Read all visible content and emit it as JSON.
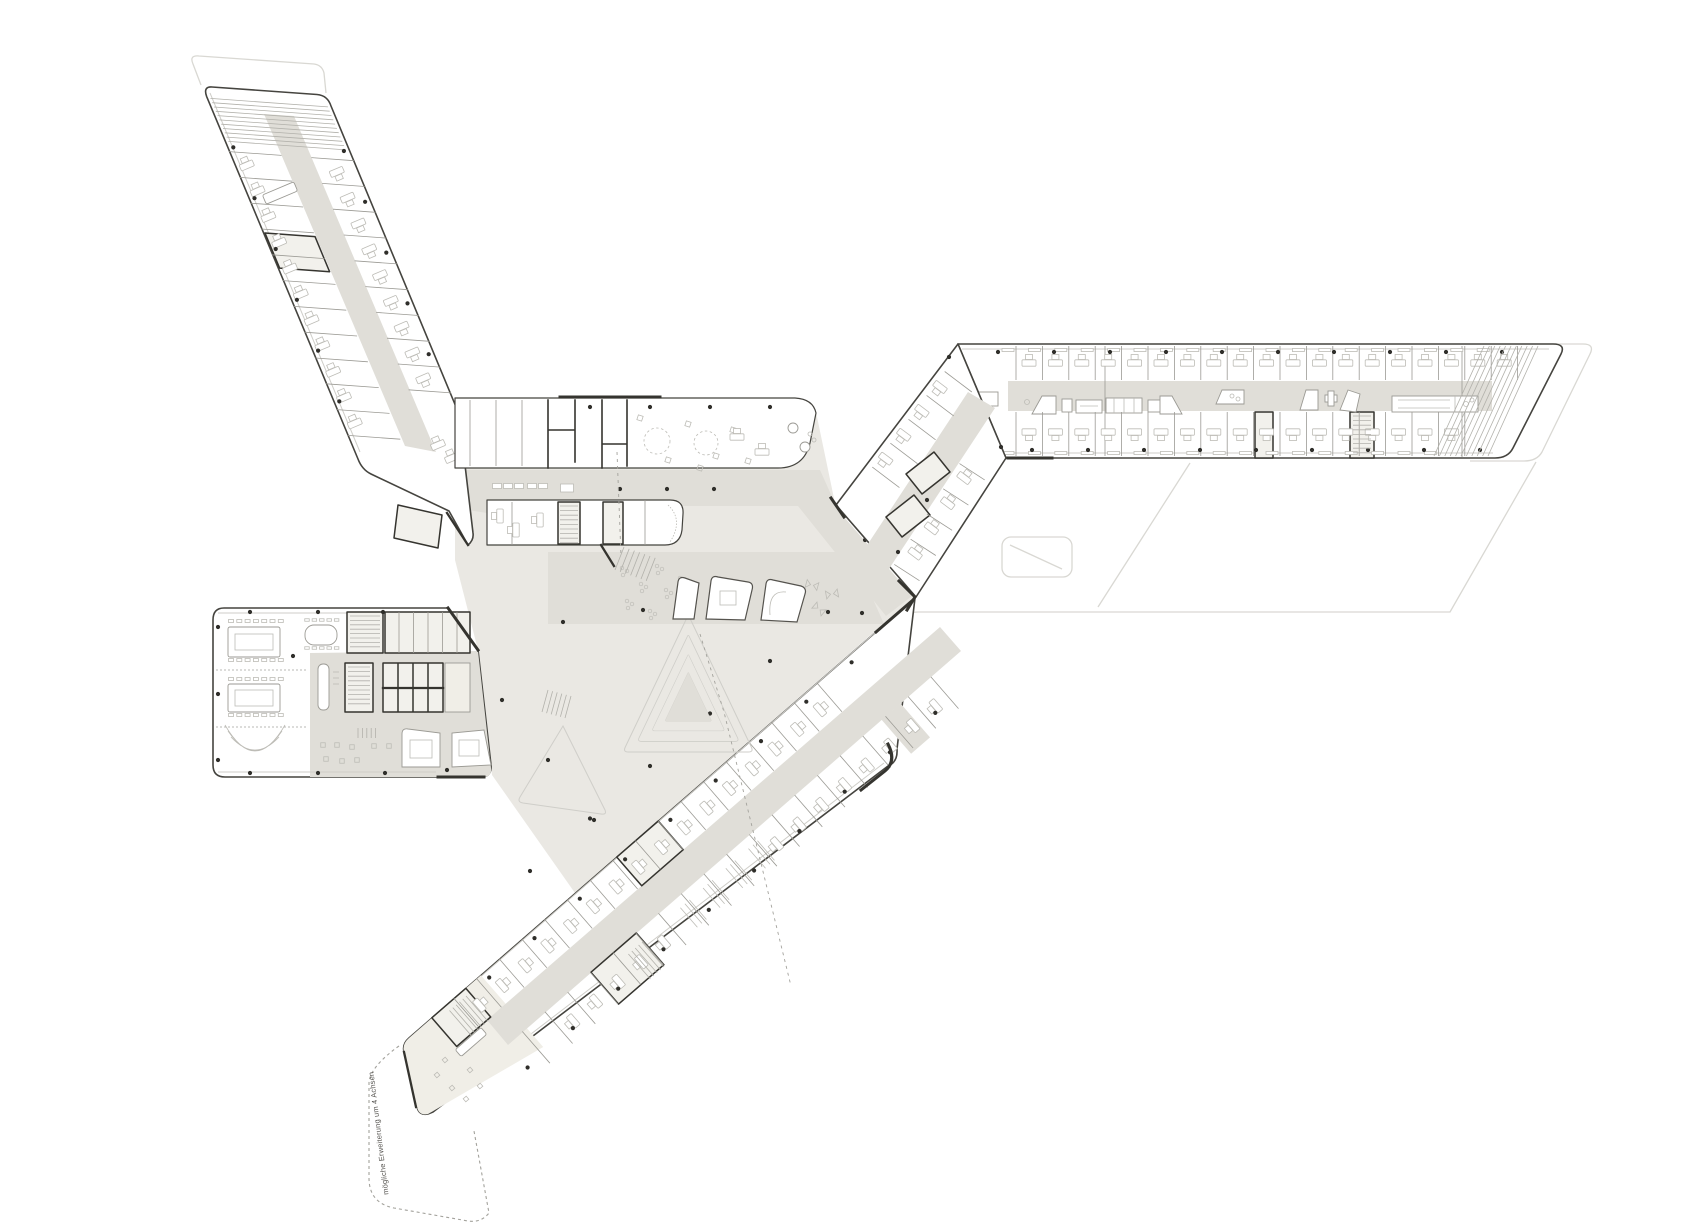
{
  "annotation": {
    "extension_label": "mögliche Erweiterung um 4 Achsen"
  },
  "areas": {
    "northwest_wing": "office wing northwest",
    "east_wing": "office wing east",
    "south_wing": "office wing south",
    "conference_block": "conference wing west",
    "central_hall": "central hall",
    "extensions": "possible extensions (ghost outlines)"
  },
  "colors": {
    "paper": "#FFFFFF",
    "hall": "#EAE8E3",
    "corridor": "#E0DED8",
    "beige": "#F0EEE7",
    "corefill": "#F2F1EC",
    "outline": "#45443F",
    "wall": "#9B9A94",
    "furn": "#BDBCB6",
    "hatch": "#B2B1AB",
    "dark": "#35342F",
    "ghost": "#D9D8D3",
    "dashline": "#A3A29C",
    "dot": "#2F2E2A",
    "faint": "#CFCEC9"
  },
  "plan": {
    "gen": [
      {
        "layer": "g-nw",
        "kind": "line",
        "s": "hatch",
        "from": [
          210.4,
          98.4
        ],
        "step": [
          1.8,
          4.3
        ],
        "n": 11,
        "vec": [
          117.5,
          8.5
        ]
      },
      {
        "layer": "g-nw",
        "kind": "line",
        "s": "wall",
        "from": [
          229,
          151.6
        ],
        "step": [
          10.8,
          25.8
        ],
        "n": 12,
        "vec": [
          52.5,
          3.8
        ]
      },
      {
        "layer": "g-nw",
        "kind": "line",
        "s": "wall",
        "from": [
          311.4,
          157.6
        ],
        "step": [
          10.8,
          25.8
        ],
        "n": 10,
        "vec": [
          42.5,
          3.1
        ]
      },
      {
        "layer": "g-nw",
        "kind": "desk",
        "from": [
          246.8,
          165.4
        ],
        "step": [
          10.8,
          25.8
        ],
        "n": 11,
        "rot": 67
      },
      {
        "layer": "g-nw",
        "kind": "desk",
        "from": [
          336.8,
          171.9
        ],
        "step": [
          10.8,
          25.8
        ],
        "n": 9,
        "rot": 247
      },
      {
        "layer": "g-nw",
        "kind": "desk",
        "pts": [
          [
            452,
            458
          ],
          [
            438,
            445
          ]
        ],
        "rot": 67
      },
      {
        "layer": "g-nw",
        "kind": "dot",
        "from": [
          233.3,
          147.4
        ],
        "step": [
          21.2,
          50.8
        ],
        "n": 6
      },
      {
        "layer": "g-nw",
        "kind": "dot",
        "from": [
          343.9,
          151
        ],
        "step": [
          21.2,
          50.8
        ],
        "n": 5
      },
      {
        "layer": "g-band",
        "kind": "line",
        "s": "wall",
        "from": [
          470,
          400
        ],
        "step": [
          26,
          0
        ],
        "n": 3,
        "vec": [
          0,
          66
        ]
      },
      {
        "layer": "g-band",
        "kind": "square",
        "pts": [
          [
            640,
            418
          ],
          [
            668,
            460
          ],
          [
            688,
            424
          ],
          [
            716,
            456
          ],
          [
            733,
            430
          ],
          [
            748,
            461
          ],
          [
            700,
            468
          ]
        ],
        "size": 5,
        "rot": 18
      },
      {
        "layer": "g-band",
        "kind": "dot",
        "from": [
          590,
          407
        ],
        "step": [
          60,
          0
        ],
        "n": 4
      },
      {
        "layer": "g-band",
        "kind": "desk",
        "pts": [
          [
            737,
            437
          ],
          [
            762,
            452
          ]
        ],
        "rot": 90
      },
      {
        "layer": "g-hallrooms",
        "kind": "cab",
        "from": [
          497,
          486
        ],
        "step": [
          11,
          0
        ],
        "n": 3,
        "w": 9,
        "h": 5
      },
      {
        "layer": "g-hallrooms",
        "kind": "cab",
        "from": [
          532,
          486
        ],
        "step": [
          11,
          0
        ],
        "n": 2,
        "w": 9,
        "h": 5
      },
      {
        "layer": "g-hallrooms",
        "kind": "cab",
        "pts": [
          [
            567,
            488
          ]
        ],
        "w": 13,
        "h": 8
      },
      {
        "layer": "g-hallrooms",
        "kind": "line",
        "s": "hatch",
        "from": [
          560,
          506
        ],
        "step": [
          0,
          4.6
        ],
        "n": 9,
        "vec": [
          18,
          0
        ]
      },
      {
        "layer": "g-hallrooms",
        "kind": "desk",
        "pts": [
          [
            500,
            516
          ],
          [
            516,
            530
          ],
          [
            540,
            520
          ]
        ],
        "rot": 0
      },
      {
        "layer": "g-hallrooms",
        "kind": "line",
        "s": "hatch",
        "from": [
          624,
          547
        ],
        "step": [
          5.2,
          1.8
        ],
        "n": 7,
        "vec": [
          -9,
          23
        ]
      },
      {
        "layer": "g-hall",
        "kind": "dot",
        "from": [
          620,
          489
        ],
        "step": [
          47,
          0
        ],
        "n": 3
      },
      {
        "layer": "g-hall",
        "kind": "dot",
        "pts": [
          [
            865,
            540
          ],
          [
            828,
            612
          ],
          [
            862,
            613
          ],
          [
            643,
            610
          ],
          [
            563,
            622
          ]
        ]
      },
      {
        "layer": "g-hall",
        "kind": "dot",
        "from": [
          770,
          661
        ],
        "step": [
          -60,
          52.5
        ],
        "n": 5
      },
      {
        "layer": "g-hall",
        "kind": "dot",
        "from": [
          502,
          700
        ],
        "step": [
          46,
          60
        ],
        "n": 4
      },
      {
        "layer": "g-hall",
        "kind": "cluster",
        "pts": [
          [
            622,
            568
          ],
          [
            641,
            584
          ],
          [
            627,
            601
          ],
          [
            657,
            566
          ],
          [
            666,
            590
          ],
          [
            650,
            611
          ],
          [
            680,
            578
          ],
          [
            690,
            600
          ]
        ]
      },
      {
        "layer": "g-hall",
        "kind": "line",
        "s": "hatch",
        "from": [
          868,
          658
        ],
        "step": [
          -3.6,
          3.2
        ],
        "n": 6,
        "vec": [
          17,
          19.6
        ]
      },
      {
        "layer": "g-hall",
        "kind": "line",
        "s": "hatch",
        "from": [
          744,
          764
        ],
        "step": [
          0,
          5
        ],
        "n": 6,
        "vec": [
          26,
          4
        ]
      },
      {
        "layer": "g-hall",
        "kind": "line",
        "s": "hatch",
        "from": [
          548,
          690
        ],
        "step": [
          4.6,
          1.2
        ],
        "n": 6,
        "vec": [
          -6,
          22
        ]
      },
      {
        "layer": "g-e",
        "kind": "line",
        "s": "wall",
        "from": [
          1016,
          346
        ],
        "step": [
          26.4,
          0
        ],
        "n": 20,
        "vec": [
          0,
          34
        ]
      },
      {
        "layer": "g-e",
        "kind": "line",
        "s": "wall",
        "from": [
          1016,
          412
        ],
        "step": [
          26.4,
          0
        ],
        "n": 18,
        "vec": [
          0,
          44
        ]
      },
      {
        "layer": "g-e",
        "kind": "desk",
        "from": [
          1029,
          363
        ],
        "step": [
          26.4,
          0
        ],
        "n": 19,
        "rot": 90
      },
      {
        "layer": "g-e",
        "kind": "desk",
        "from": [
          1029,
          432
        ],
        "step": [
          26.4,
          0
        ],
        "n": 17,
        "rot": 270
      },
      {
        "layer": "g-e",
        "kind": "cab",
        "from": [
          1008,
          350
        ],
        "step": [
          26.4,
          0
        ],
        "n": 19,
        "w": 12,
        "h": 3
      },
      {
        "layer": "g-e",
        "kind": "cab",
        "from": [
          1008,
          453
        ],
        "step": [
          26.4,
          0
        ],
        "n": 17,
        "w": 12,
        "h": 3
      },
      {
        "layer": "g-e",
        "kind": "dot",
        "from": [
          998,
          352
        ],
        "step": [
          56,
          0
        ],
        "n": 10
      },
      {
        "layer": "g-e",
        "kind": "dot",
        "from": [
          1032,
          450
        ],
        "step": [
          56,
          0
        ],
        "n": 9
      },
      {
        "layer": "g-e",
        "kind": "line",
        "s": "hatch",
        "from": [
          1484,
          346
        ],
        "step": [
          5.4,
          0
        ],
        "n": 11,
        "vec": [
          -50,
          110
        ]
      },
      {
        "layer": "g-e",
        "kind": "line",
        "s": "hatch",
        "from": [
          1353,
          416
        ],
        "step": [
          0,
          4.6
        ],
        "n": 9,
        "vec": [
          18,
          0
        ]
      },
      {
        "layer": "g-conn",
        "kind": "line",
        "s": "wall",
        "from": [
          944.7,
          371.5
        ],
        "step": [
          -18.1,
          23.9
        ],
        "n": 5,
        "vec": [
          27.1,
          20.5
        ]
      },
      {
        "layer": "g-conn",
        "kind": "line",
        "s": "wall",
        "from": [
          984.7,
          479.9
        ],
        "step": [
          -16.3,
          25.2
        ],
        "n": 5,
        "vec": [
          -25.2,
          -16.3
        ]
      },
      {
        "layer": "g-conn",
        "kind": "desk",
        "from": [
          940,
          387
        ],
        "step": [
          -18.1,
          23.9
        ],
        "n": 4,
        "rot": -53
      },
      {
        "layer": "g-conn",
        "kind": "desk",
        "from": [
          964,
          478
        ],
        "step": [
          -16.3,
          25.2
        ],
        "n": 4,
        "rot": 127
      },
      {
        "layer": "g-conn",
        "kind": "dot",
        "pts": [
          [
            949,
            357
          ],
          [
            1001,
            447
          ],
          [
            927,
            500
          ],
          [
            898,
            552
          ]
        ]
      },
      {
        "layer": "g-block",
        "kind": "dot",
        "pts": [
          [
            218,
            627
          ],
          [
            218,
            694
          ],
          [
            218,
            760
          ],
          [
            250,
            612
          ],
          [
            318,
            612
          ],
          [
            383,
            612
          ],
          [
            250,
            773
          ],
          [
            318,
            773
          ],
          [
            385,
            773
          ],
          [
            447,
            770
          ],
          [
            293,
            656
          ]
        ]
      },
      {
        "layer": "g-block",
        "kind": "square",
        "pts": [
          [
            323,
            745
          ],
          [
            337,
            745
          ],
          [
            352,
            747
          ],
          [
            326,
            759
          ],
          [
            342,
            761
          ],
          [
            357,
            760
          ],
          [
            374,
            746
          ],
          [
            389,
            746
          ]
        ],
        "size": 4.5,
        "rot": 0
      },
      {
        "layer": "g-block",
        "kind": "line",
        "s": "hatch",
        "from": [
          358,
          728
        ],
        "step": [
          4.4,
          0
        ],
        "n": 5,
        "vec": [
          0,
          10
        ]
      },
      {
        "layer": "g-block",
        "kind": "cab",
        "from": [
          231,
          621
        ],
        "step": [
          8.3,
          0
        ],
        "n": 7,
        "w": 5,
        "h": 3
      },
      {
        "layer": "g-block",
        "kind": "cab",
        "from": [
          231,
          660
        ],
        "step": [
          8.3,
          0
        ],
        "n": 7,
        "w": 5,
        "h": 3
      },
      {
        "layer": "g-block",
        "kind": "cab",
        "from": [
          231,
          679
        ],
        "step": [
          8.3,
          0
        ],
        "n": 7,
        "w": 5,
        "h": 3
      },
      {
        "layer": "g-block",
        "kind": "cab",
        "from": [
          231,
          715
        ],
        "step": [
          8.3,
          0
        ],
        "n": 7,
        "w": 5,
        "h": 3
      },
      {
        "layer": "g-block",
        "kind": "cab",
        "from": [
          307,
          620
        ],
        "step": [
          7.4,
          0
        ],
        "n": 5,
        "w": 4.5,
        "h": 2.5
      },
      {
        "layer": "g-block",
        "kind": "cab",
        "from": [
          307,
          648
        ],
        "step": [
          7.4,
          0
        ],
        "n": 5,
        "w": 4.5,
        "h": 2.5
      },
      {
        "layer": "g-block",
        "kind": "line",
        "s": "hatch",
        "from": [
          350,
          616
        ],
        "step": [
          0,
          4.4
        ],
        "n": 8,
        "vec": [
          30,
          0
        ]
      },
      {
        "layer": "g-block",
        "kind": "line",
        "s": "hatch",
        "from": [
          348,
          667
        ],
        "step": [
          0,
          4.6
        ],
        "n": 9,
        "vec": [
          22,
          0
        ]
      },
      {
        "layer": "g-block",
        "kind": "line",
        "s": "wall",
        "from": [
          399,
          612
        ],
        "step": [
          14.5,
          0
        ],
        "n": 5,
        "vec": [
          0,
          41
        ]
      },
      {
        "layer": "g-block",
        "kind": "line",
        "s": "dark",
        "from": [
          398,
          663
        ],
        "step": [
          15,
          0
        ],
        "n": 3,
        "vec": [
          0,
          49
        ]
      },
      {
        "layer": "g-block",
        "kind": "line",
        "s": "furn",
        "from": [
          333,
          672
        ],
        "step": [
          0,
          6
        ],
        "n": 3,
        "vec": [
          6,
          0
        ]
      },
      {
        "layer": "g-s",
        "kind": "line",
        "s": "wall",
        "from": [
          817,
          683
        ],
        "step": [
          -22.7,
          19.7
        ],
        "n": 17,
        "vec": [
          24.9,
          28.7
        ]
      },
      {
        "layer": "g-s",
        "kind": "line",
        "s": "wall",
        "from": [
          930.9,
          676.9
        ],
        "step": [
          -22.7,
          19.7
        ],
        "n": 19,
        "vec": [
          27.6,
          31.7
        ]
      },
      {
        "layer": "g-s",
        "kind": "desk",
        "from": [
          819.9,
          709.7
        ],
        "step": [
          -22.7,
          19.7
        ],
        "n": 16,
        "rot": 139
      },
      {
        "layer": "g-s",
        "kind": "desk",
        "from": [
          935.8,
          705.8
        ],
        "step": [
          -22.7,
          19.7
        ],
        "n": 8,
        "rot": 319
      },
      {
        "layer": "g-s",
        "kind": "desk",
        "from": [
          664,
          942
        ],
        "step": [
          -22.7,
          19.7
        ],
        "n": 5,
        "rot": 319
      },
      {
        "layer": "g-s",
        "kind": "line",
        "s": "furn",
        "from": [
          748.5,
          848.6
        ],
        "step": [
          -22.7,
          19.7
        ],
        "n": 4,
        "vec": [
          17,
          19.6
        ]
      },
      {
        "layer": "g-s",
        "kind": "line",
        "s": "furn",
        "from": [
          753,
          844.7
        ],
        "step": [
          -22.7,
          19.7
        ],
        "n": 4,
        "vec": [
          17,
          19.6
        ]
      },
      {
        "layer": "g-s",
        "kind": "line",
        "s": "furn",
        "from": [
          757.5,
          840.8
        ],
        "step": [
          -22.7,
          19.7
        ],
        "n": 4,
        "vec": [
          17,
          19.6
        ]
      },
      {
        "layer": "g-s",
        "kind": "dot",
        "from": [
          851.6,
          662.3
        ],
        "step": [
          -45.3,
          39.4
        ],
        "n": 9
      },
      {
        "layer": "g-s",
        "kind": "dot",
        "from": [
          935.3,
          712.9
        ],
        "step": [
          -45.3,
          39.4
        ],
        "n": 10
      },
      {
        "layer": "g-s",
        "kind": "line",
        "s": "hatch",
        "from": [
          466,
          996
        ],
        "step": [
          -3.3,
          2.9
        ],
        "n": 6,
        "vec": [
          22,
          25.3
        ]
      },
      {
        "layer": "g-s",
        "kind": "line",
        "s": "hatch",
        "from": [
          642,
          942
        ],
        "step": [
          -3.4,
          3
        ],
        "n": 5,
        "vec": [
          22,
          25
        ]
      },
      {
        "layer": "g-s",
        "kind": "square",
        "pts": [
          [
            445,
            1060
          ],
          [
            437,
            1075
          ],
          [
            452,
            1088
          ],
          [
            466,
            1099
          ],
          [
            480,
            1086
          ],
          [
            470,
            1070
          ]
        ],
        "size": 4,
        "rot": -41
      }
    ]
  }
}
